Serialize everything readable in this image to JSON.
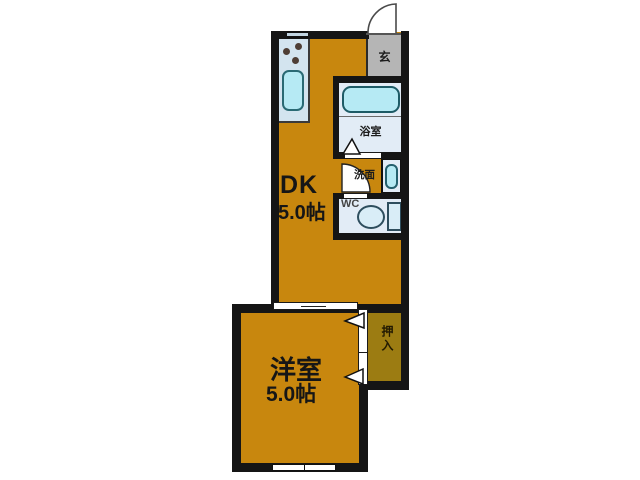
{
  "title": "floor-plan",
  "rooms": {
    "dk": {
      "name": "DK",
      "size": "5.0帖"
    },
    "western_room": {
      "name": "洋室",
      "size": "5.0帖"
    },
    "entrance": {
      "label": "玄"
    },
    "bathroom": {
      "label": "浴室"
    },
    "washroom": {
      "label": "洗面"
    },
    "wc": {
      "label": "WC"
    },
    "closet": {
      "label": "押入"
    }
  },
  "icons": [
    "entrance-door-swing-icon",
    "washroom-door-swing-icon",
    "bathroom-door-triangle-icon",
    "sliding-door-triangle-icon",
    "kitchen-sink-icon",
    "stove-burner-icon",
    "bathtub-icon",
    "washbasin-icon",
    "toilet-icon",
    "window-icon"
  ],
  "colors": {
    "floor": "#c8870e",
    "closet": "#9c7c12",
    "entrance": "#b5b5b5",
    "kitchen": "#d3e4ef",
    "fixture": "#e2ecf6",
    "water": "#b6eaf4",
    "wall": "#151515",
    "window": "#c2d5e2"
  }
}
